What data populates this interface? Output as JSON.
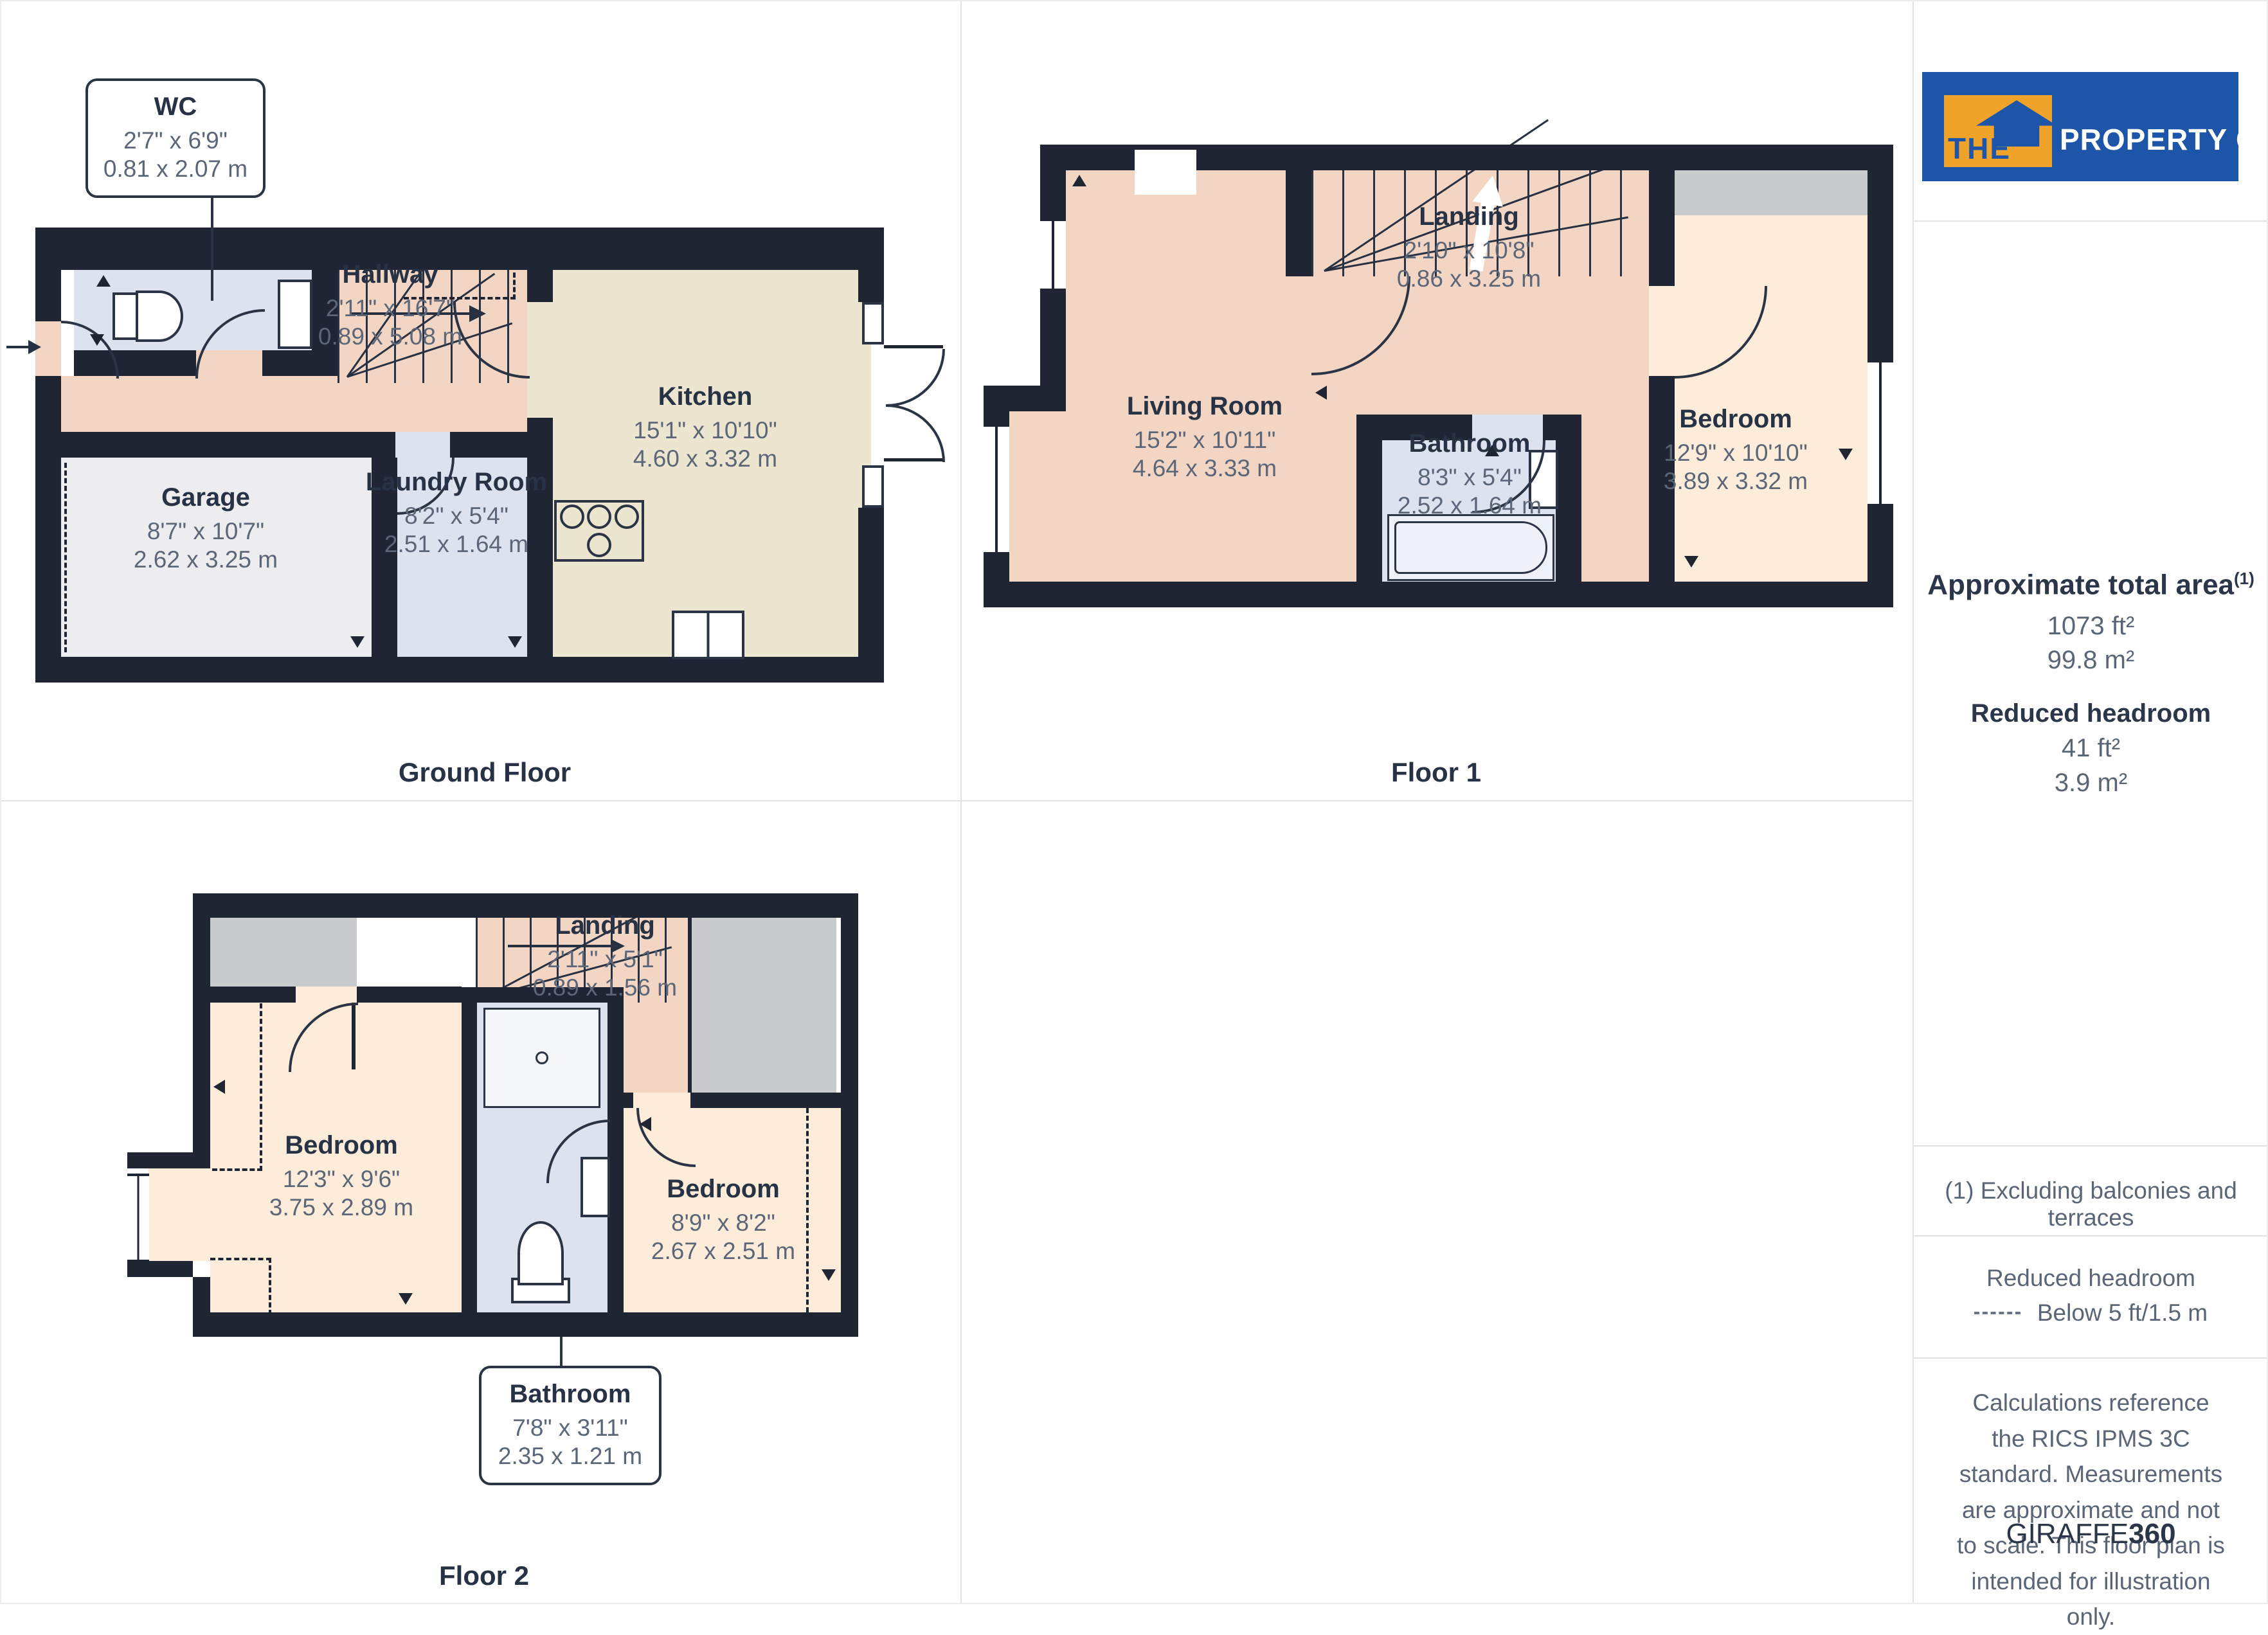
{
  "floors": {
    "ground": {
      "label": "Ground Floor",
      "rooms": {
        "wc": {
          "name": "WC",
          "imperial": "2'7\" x 6'9\"",
          "metric": "0.81 x 2.07 m"
        },
        "hallway": {
          "name": "Hallway",
          "imperial": "2'11\" x 16'7\"",
          "metric": "0.89 x 5.08 m"
        },
        "kitchen": {
          "name": "Kitchen",
          "imperial": "15'1\" x 10'10\"",
          "metric": "4.60 x 3.32 m"
        },
        "garage": {
          "name": "Garage",
          "imperial": "8'7\" x 10'7\"",
          "metric": "2.62 x 3.25 m"
        },
        "laundry": {
          "name": "Laundry Room",
          "imperial": "8'2\" x 5'4\"",
          "metric": "2.51 x 1.64 m"
        }
      }
    },
    "floor1": {
      "label": "Floor 1",
      "rooms": {
        "living": {
          "name": "Living Room",
          "imperial": "15'2\" x 10'11\"",
          "metric": "4.64 x 3.33 m"
        },
        "landing": {
          "name": "Landing",
          "imperial": "2'10\" x 10'8\"",
          "metric": "0.86 x 3.25 m"
        },
        "bathroom": {
          "name": "Bathroom",
          "imperial": "8'3\" x 5'4\"",
          "metric": "2.52 x 1.64 m"
        },
        "bedroom": {
          "name": "Bedroom",
          "imperial": "12'9\" x 10'10\"",
          "metric": "3.89 x 3.32 m"
        }
      }
    },
    "floor2": {
      "label": "Floor 2",
      "rooms": {
        "landing": {
          "name": "Landing",
          "imperial": "2'11\" x 5'1\"",
          "metric": "0.89 x 1.56 m"
        },
        "bedroom_left": {
          "name": "Bedroom",
          "imperial": "12'3\" x 9'6\"",
          "metric": "3.75 x 2.89 m"
        },
        "bedroom_right": {
          "name": "Bedroom",
          "imperial": "8'9\" x 8'2\"",
          "metric": "2.67 x 2.51 m"
        },
        "bathroom": {
          "name": "Bathroom",
          "imperial": "7'8\" x 3'11\"",
          "metric": "2.35 x 1.21 m"
        }
      }
    }
  },
  "sidebar": {
    "logo": {
      "the": "THE",
      "rest": "PROPERTY CENTRE"
    },
    "area": {
      "title": "Approximate total area",
      "marker": "(1)",
      "ft": "1073 ft²",
      "m": "99.8 m²",
      "reduced_title": "Reduced headroom",
      "reduced_ft": "41 ft²",
      "reduced_m": "3.9 m²"
    },
    "footnote": "(1) Excluding balconies and terraces",
    "legend": {
      "title": "Reduced headroom",
      "item": "Below 5 ft/1.5 m"
    },
    "disclaimer": "Calculations reference the RICS IPMS 3C standard. Measurements are approximate and not to scale. This floor plan is intended for illustration only.",
    "brand": {
      "giraffe": "GIRAFFE",
      "num": "360"
    }
  },
  "colors": {
    "wall": "#1f2532",
    "hall_salmon": "#f3d5c3",
    "bedroom_peach": "#fcecd9",
    "kitchen_beige": "#ece5d0",
    "bath_blue": "#dce2ee",
    "garage_gray": "#ededf0",
    "void_gray": "#c9cacb",
    "logo_blue": "#1d55a8",
    "logo_orange": "#f0a32b"
  }
}
